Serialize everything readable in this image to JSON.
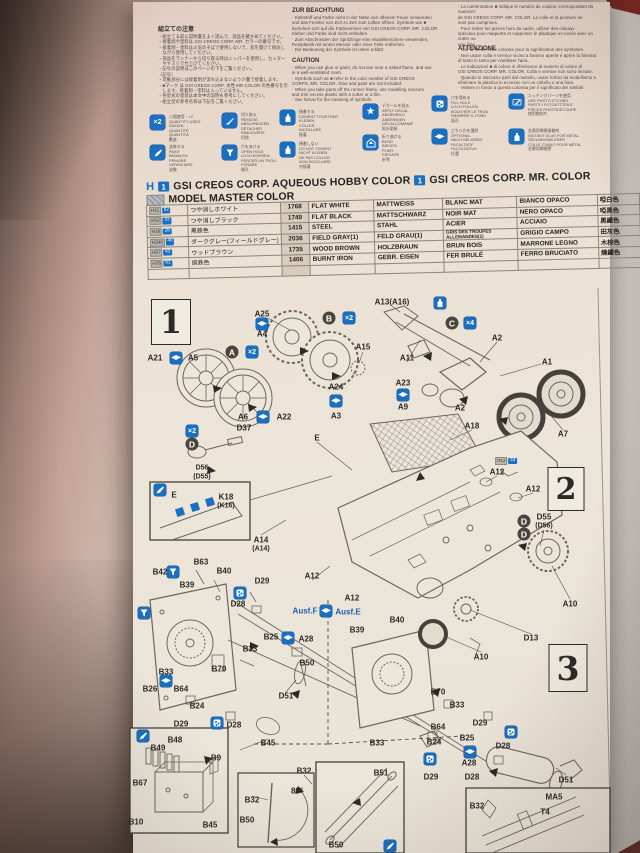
{
  "colors": {
    "accent_blue": "#1a6fc0",
    "badge_dark": "#4a443c",
    "ink": "#2c2a27",
    "maroon_corner": "#7b2822"
  },
  "sheet": {
    "notes_jp": {
      "title": "組立ての注意",
      "lines": [
        "・組立てる前に説明書をよく読んで、部品を確かめてください。",
        "・接着剤や塗料は GSI CREOS CORP. MR. カラーの番号です。",
        "・接着剤・塗料は火気のそばで使用しないで、窓を開けて換気し",
        "　ながら使用してください。",
        "・部品をランナーから切り取る時はニッパーを使用し、カッター",
        "　やヤスリで仕上げてください。",
        "・記号の説明はこのページの下をご覧ください。",
        "〈記号〉",
        "・可動部分には接着剤が流れ込まないよう少量で接着します。",
        "・■マーク は GSI CREOS CORP. 水性 MR.COLOR の色番号を示",
        "　します。接着剤・塗料は入っていません。",
        "・各型式の塗装は本文中の説明も参考にしてください。",
        "・組立型の参考名称は下記をご覧ください。"
      ]
    },
    "notes_de": {
      "title": "ZUR BEACHTUNG",
      "lines": [
        "· Klebstoff und Farbe nicht in der Nähe von offenem Feuer verwenden",
        "  und das Fenster von Zeit zu Zeit zum Lüften öffnen. Symbole wie ■",
        "  beziehen sich auf die Farbnummer von GSI CREOS CORP. MR. COLOR.",
        "  Kleber und Farbe sind nicht enthalten.",
        "· Zum Abschneiden der Spritzlinge eine Modellierschere verwenden,",
        "  Restplastik mit einem Messer oder einer Feile entfernen.",
        "· Die Bedeutung der Symbole ist unten erklärt."
      ]
    },
    "notes_en": {
      "title": "CAUTION",
      "lines": [
        "· When you use glue or paint, do not use near a naked flame, and use",
        "  in a well-ventilated room.",
        "· Symbols such as ■ refer to the color number of GSI CREOS",
        "  CORPS. MR. COLOR. Glue and paint are not included.",
        "· When you take parts off the runner frame, use modeling scissors",
        "  and trim excess plastic with a cutter or a file.",
        "· See below for the meaning of symbols."
      ]
    },
    "notes_fr": {
      "title": "",
      "lines": [
        "· La numérotation ■ indique le numéro de couleur correspondant du nuancier",
        "  de GSI CREOS CORP. MR. COLOR. La colle et la peinture ne",
        "  sont pas comprises.",
        "· Pour retirer les pièces hors du cadre, utiliser des ciseaux",
        "  spéciaux pour maquette et supprimer le plastique en excès avec un cutter ou",
        "  une lime.",
        "· Voir la fin de cette colonne pour la signification des symboles."
      ]
    },
    "notes_it": {
      "title": "ATTENZIONE",
      "lines": [
        "· Non usare colla e vernice vicino a fiamme aperte e aprire la finestra",
        "  di tanto in tanto per cambiare l'aria.",
        "· Le indicazioni ■ di colore si riferiscono al numero di colore di",
        "  GSI CREOS CORP. MR. COLOR. Colla e vernice non sono incluse.",
        "· Quando si staccano parti dal castello, usare forbici da modellismo e",
        "  eliminare la plastica in eccesso con un coltello o una lima.",
        "· Vedere in fondo a questa colonna per il significato dei simboli."
      ]
    },
    "legend": [
      {
        "icon": "x2",
        "x": 150,
        "y": 115,
        "lines": [
          "二個使用・×2",
          "QUANTITY USED",
          "ANZAHL",
          "QUANTITÉ",
          "QUANTITÀ",
          "數量"
        ]
      },
      {
        "icon": "knife",
        "x": 222,
        "y": 113,
        "lines": [
          "切り取る",
          "REMOVE",
          "ABSCHNEIDEN",
          "DÉTACHER",
          "RIMUOVERE",
          "切除"
        ]
      },
      {
        "icon": "glue",
        "x": 280,
        "y": 110,
        "lines": [
          "接着する",
          "CEMENT TOGETHER",
          "KLEBEN",
          "COLLER",
          "INCOLLARE",
          "接著"
        ]
      },
      {
        "icon": "star",
        "x": 363,
        "y": 104,
        "lines": [
          "デカールを貼る",
          "APPLY DECAL",
          "ABZIEHBILD",
          "ANBRINGEN",
          "DÉCALCOMANIE",
          "貼水貼紙"
        ]
      },
      {
        "icon": "fill",
        "x": 432,
        "y": 96,
        "lines": [
          "穴を埋める",
          "FILL HOLE",
          "LOCH FÜLLEN",
          "BOUCHER LE TROU",
          "RIEMPIRE IL FORO",
          "填孔"
        ]
      },
      {
        "icon": "scribe",
        "x": 509,
        "y": 94,
        "lines": [
          "エッチングパーツを使用",
          "USE PHOTO-ETCHED",
          "PARTS / FOTOÄTZTEILE",
          "PIÈCES PHOTODÉCOUPE",
          "使用蝕刻片"
        ]
      },
      {
        "icon": "brush",
        "x": 150,
        "y": 145,
        "lines": [
          "塗装する",
          "PAINT",
          "BEMALEN",
          "PEINDRE",
          "VERNICIARE",
          "塗裝"
        ]
      },
      {
        "icon": "funnel",
        "x": 222,
        "y": 145,
        "lines": [
          "穴をあける",
          "OPEN HOLE",
          "LOCH BOHREN",
          "PERCER UN TROU",
          "FORARE",
          "開孔"
        ]
      },
      {
        "icon": "glue2",
        "x": 280,
        "y": 142,
        "lines": [
          "接着しない",
          "DO NOT CEMENT",
          "NICHT KLEBEN",
          "NE PAS COLLER",
          "NON INCOLLARE",
          "勿接著"
        ]
      },
      {
        "icon": "pentagon",
        "x": 363,
        "y": 135,
        "lines": [
          "折り曲げる",
          "BEND",
          "BIEGEN",
          "PLIER",
          "PIEGARE",
          "折彎"
        ]
      },
      {
        "icon": "opt",
        "x": 432,
        "y": 129,
        "lines": [
          "どちらかを選択",
          "OPTIONAL",
          "NACH BELIEBEN",
          "FACULTATIF",
          "FACOLTATIVO",
          "任選"
        ]
      },
      {
        "icon": "ca",
        "x": 509,
        "y": 129,
        "lines": [
          "金属用瞬間接着剤",
          "INSTANT GLUE FOR METAL",
          "SEKUNDENKLEBER",
          "COLLE CYANO POUR MÉTAL",
          "金屬用瞬間膠"
        ]
      }
    ],
    "paint_header": {
      "aq_mark": "H",
      "aq_num": "1",
      "aq_label": "GSI CREOS CORP. AQUEOUS HOBBY COLOR",
      "mr_num": "1",
      "mr_label": "GSI CREOS CORP. MR. COLOR",
      "mm_label": "MODEL MASTER COLOR"
    },
    "paint_table": {
      "rows": [
        {
          "aq": "H11",
          "mr": "62",
          "jp": "つや消しホワイト",
          "mm": "1768",
          "en": "FLAT WHITE",
          "de": "MATTWEISS",
          "fr": "BLANC MAT",
          "it": "BIANCO OPACO",
          "cn": "啞白色"
        },
        {
          "aq": "H12",
          "mr": "33",
          "jp": "つや消しブラック",
          "mm": "1749",
          "en": "FLAT BLACK",
          "de": "MATTSCHWARZ",
          "fr": "NOIR MAT",
          "it": "NERO OPACO",
          "cn": "啞黑色"
        },
        {
          "aq": "H18",
          "mr": "28",
          "jp": "黒鉄色",
          "mm": "1415",
          "en": "STEEL",
          "de": "STAHL",
          "fr": "ACIER",
          "it": "ACCIAIO",
          "cn": "黑鐵色"
        },
        {
          "aq": "H340",
          "mr": "40",
          "jp": "ダークグレー(フィールドグレー)",
          "mm": "2036",
          "en": "FIELD GRAY(1)",
          "de": "FELD GRAU(1)",
          "fr": "GRIS DES TROUPES ALLEMANDES(1)",
          "it": "GRIGIO CAMPO",
          "cn": "田灰色"
        },
        {
          "aq": "H37",
          "mr": "43",
          "jp": "ウッドブラウン",
          "mm": "1735",
          "en": "WOOD BROWN",
          "de": "HOLZBRAUN",
          "fr": "BRUN BOIS",
          "it": "MARRONE LEGNO",
          "cn": "木棕色"
        },
        {
          "aq": "H76",
          "mr": "61",
          "jp": "焼鉄色",
          "mm": "1406",
          "en": "BURNT IRON",
          "de": "GEBR. EISEN",
          "fr": "FER BRULÉ",
          "it": "FERRO BRUCIATO",
          "cn": "燒鐵色"
        },
        {
          "aq": "",
          "mr": "",
          "jp": "",
          "mm": "",
          "en": "",
          "de": "",
          "fr": "",
          "it": "",
          "cn": ""
        }
      ]
    },
    "diagram": {
      "steps": [
        {
          "n": "1",
          "x": 171,
          "y": 322,
          "w": 38,
          "h": 44
        },
        {
          "n": "2",
          "x": 566,
          "y": 489,
          "w": 35,
          "h": 42
        },
        {
          "n": "3",
          "x": 568,
          "y": 668,
          "w": 37,
          "h": 46
        }
      ],
      "labels": [
        {
          "t": "A25",
          "x": 262,
          "y": 314
        },
        {
          "t": "A4",
          "x": 262,
          "y": 334
        },
        {
          "t": "A15",
          "x": 363,
          "y": 347
        },
        {
          "t": "A21",
          "x": 155,
          "y": 358
        },
        {
          "t": "A5",
          "x": 193,
          "y": 358
        },
        {
          "t": "A6",
          "x": 243,
          "y": 417
        },
        {
          "t": "A22",
          "x": 284,
          "y": 417
        },
        {
          "t": "A24",
          "x": 336,
          "y": 387
        },
        {
          "t": "A3",
          "x": 336,
          "y": 416
        },
        {
          "t": "D37",
          "x": 244,
          "y": 428
        },
        {
          "t": "D56",
          "x": 202,
          "y": 468,
          "c": "small"
        },
        {
          "t": "(D55)",
          "x": 202,
          "y": 477,
          "c": "small"
        },
        {
          "t": "E",
          "x": 317,
          "y": 438
        },
        {
          "t": "A13(A16)",
          "x": 392,
          "y": 302
        },
        {
          "t": "A2",
          "x": 497,
          "y": 338
        },
        {
          "t": "A11",
          "x": 407,
          "y": 358
        },
        {
          "t": "A1",
          "x": 547,
          "y": 362
        },
        {
          "t": "A23",
          "x": 403,
          "y": 383
        },
        {
          "t": "A9",
          "x": 403,
          "y": 407
        },
        {
          "t": "A2",
          "x": 460,
          "y": 408
        },
        {
          "t": "A7",
          "x": 563,
          "y": 434
        },
        {
          "t": "A18",
          "x": 472,
          "y": 426
        },
        {
          "t": "E",
          "x": 174,
          "y": 495
        },
        {
          "t": "K18",
          "x": 226,
          "y": 497
        },
        {
          "t": "(K16)",
          "x": 226,
          "y": 506,
          "c": "small"
        },
        {
          "t": "A14",
          "x": 261,
          "y": 540
        },
        {
          "t": "(A14)",
          "x": 261,
          "y": 549,
          "c": "small"
        },
        {
          "t": "A12",
          "x": 497,
          "y": 472
        },
        {
          "t": "A12",
          "x": 533,
          "y": 489
        },
        {
          "t": "D55",
          "x": 544,
          "y": 517
        },
        {
          "t": "(D56)",
          "x": 544,
          "y": 526,
          "c": "small"
        },
        {
          "t": "A10",
          "x": 570,
          "y": 604
        },
        {
          "t": "A12",
          "x": 312,
          "y": 576
        },
        {
          "t": "B42",
          "x": 160,
          "y": 572
        },
        {
          "t": "B63",
          "x": 201,
          "y": 562
        },
        {
          "t": "B40",
          "x": 224,
          "y": 571
        },
        {
          "t": "B39",
          "x": 187,
          "y": 585
        },
        {
          "t": "D29",
          "x": 262,
          "y": 581
        },
        {
          "t": "D28",
          "x": 238,
          "y": 604
        },
        {
          "t": "Ausf.F",
          "x": 305,
          "y": 611,
          "c": "blue"
        },
        {
          "t": "Ausf.E",
          "x": 348,
          "y": 612,
          "c": "blue"
        },
        {
          "t": "B25",
          "x": 271,
          "y": 637
        },
        {
          "t": "A28",
          "x": 306,
          "y": 639
        },
        {
          "t": "B33",
          "x": 250,
          "y": 649
        },
        {
          "t": "B50",
          "x": 307,
          "y": 663
        },
        {
          "t": "B70",
          "x": 219,
          "y": 669
        },
        {
          "t": "B33",
          "x": 166,
          "y": 672
        },
        {
          "t": "B26",
          "x": 150,
          "y": 689
        },
        {
          "t": "B64",
          "x": 181,
          "y": 689
        },
        {
          "t": "B24",
          "x": 197,
          "y": 706
        },
        {
          "t": "D51",
          "x": 286,
          "y": 696
        },
        {
          "t": "D29",
          "x": 181,
          "y": 724
        },
        {
          "t": "D28",
          "x": 234,
          "y": 725
        },
        {
          "t": "B48",
          "x": 175,
          "y": 740
        },
        {
          "t": "B45",
          "x": 268,
          "y": 743
        },
        {
          "t": "A12",
          "x": 352,
          "y": 598
        },
        {
          "t": "B39",
          "x": 357,
          "y": 630
        },
        {
          "t": "B40",
          "x": 397,
          "y": 620
        },
        {
          "t": "A10",
          "x": 481,
          "y": 657
        },
        {
          "t": "D13",
          "x": 531,
          "y": 638
        },
        {
          "t": "B70",
          "x": 438,
          "y": 692
        },
        {
          "t": "B33",
          "x": 457,
          "y": 705
        },
        {
          "t": "B64",
          "x": 438,
          "y": 727
        },
        {
          "t": "B24",
          "x": 434,
          "y": 742
        },
        {
          "t": "D29",
          "x": 480,
          "y": 723
        },
        {
          "t": "B25",
          "x": 467,
          "y": 738
        },
        {
          "t": "D28",
          "x": 503,
          "y": 746
        },
        {
          "t": "A28",
          "x": 469,
          "y": 763
        },
        {
          "t": "D28",
          "x": 472,
          "y": 777
        },
        {
          "t": "D51",
          "x": 566,
          "y": 780
        },
        {
          "t": "B33",
          "x": 377,
          "y": 743
        },
        {
          "t": "D29",
          "x": 431,
          "y": 777
        },
        {
          "t": "B49",
          "x": 158,
          "y": 748
        },
        {
          "t": "B9",
          "x": 216,
          "y": 758
        },
        {
          "t": "B67",
          "x": 140,
          "y": 783
        },
        {
          "t": "B10",
          "x": 136,
          "y": 822
        },
        {
          "t": "B45",
          "x": 210,
          "y": 825
        },
        {
          "t": "B32",
          "x": 252,
          "y": 800
        },
        {
          "t": "B50",
          "x": 247,
          "y": 820
        },
        {
          "t": "80°",
          "x": 297,
          "y": 791
        },
        {
          "t": "B32",
          "x": 304,
          "y": 771
        },
        {
          "t": "B51",
          "x": 381,
          "y": 773
        },
        {
          "t": "B50",
          "x": 336,
          "y": 845
        },
        {
          "t": "B32",
          "x": 477,
          "y": 806
        },
        {
          "t": "MA5",
          "x": 554,
          "y": 797
        },
        {
          "t": "T4",
          "x": 545,
          "y": 812
        }
      ],
      "icons": [
        {
          "k": "opt",
          "x": 176,
          "y": 358
        },
        {
          "k": "opt",
          "x": 262,
          "y": 324
        },
        {
          "k": "opt",
          "x": 336,
          "y": 401
        },
        {
          "k": "opt",
          "x": 263,
          "y": 417
        },
        {
          "k": "opt",
          "x": 403,
          "y": 395
        },
        {
          "k": "opt",
          "x": 288,
          "y": 638
        },
        {
          "k": "opt",
          "x": 166,
          "y": 681
        },
        {
          "k": "opt",
          "x": 326,
          "y": 611
        },
        {
          "k": "opt",
          "x": 470,
          "y": 752
        },
        {
          "k": "x2",
          "x": 252,
          "y": 352,
          "t": "×2"
        },
        {
          "k": "x2",
          "x": 349,
          "y": 318,
          "t": "×2"
        },
        {
          "k": "x2",
          "x": 192,
          "y": 431,
          "t": "×2"
        },
        {
          "k": "x4",
          "x": 470,
          "y": 323,
          "t": "×4"
        },
        {
          "k": "badge",
          "x": 232,
          "y": 352,
          "t": "A"
        },
        {
          "k": "badge",
          "x": 329,
          "y": 318,
          "t": "B"
        },
        {
          "k": "badge",
          "x": 452,
          "y": 323,
          "t": "C"
        },
        {
          "k": "badge",
          "x": 192,
          "y": 444,
          "t": "D"
        },
        {
          "k": "badge",
          "x": 524,
          "y": 521,
          "t": "D"
        },
        {
          "k": "badge",
          "x": 524,
          "y": 534,
          "t": "D"
        },
        {
          "k": "glue",
          "x": 440,
          "y": 303
        },
        {
          "k": "fill",
          "x": 240,
          "y": 593
        },
        {
          "k": "fill",
          "x": 217,
          "y": 723
        },
        {
          "k": "fill",
          "x": 511,
          "y": 732
        },
        {
          "k": "fill",
          "x": 430,
          "y": 759
        },
        {
          "k": "funnel",
          "x": 173,
          "y": 572
        },
        {
          "k": "funnel",
          "x": 144,
          "y": 613
        },
        {
          "k": "brush",
          "x": 160,
          "y": 490
        },
        {
          "k": "brush",
          "x": 143,
          "y": 736
        },
        {
          "k": "brush",
          "x": 390,
          "y": 846
        }
      ],
      "paint_callout": {
        "aq": "H12",
        "mr": "33",
        "x": 506,
        "y": 461
      }
    }
  }
}
